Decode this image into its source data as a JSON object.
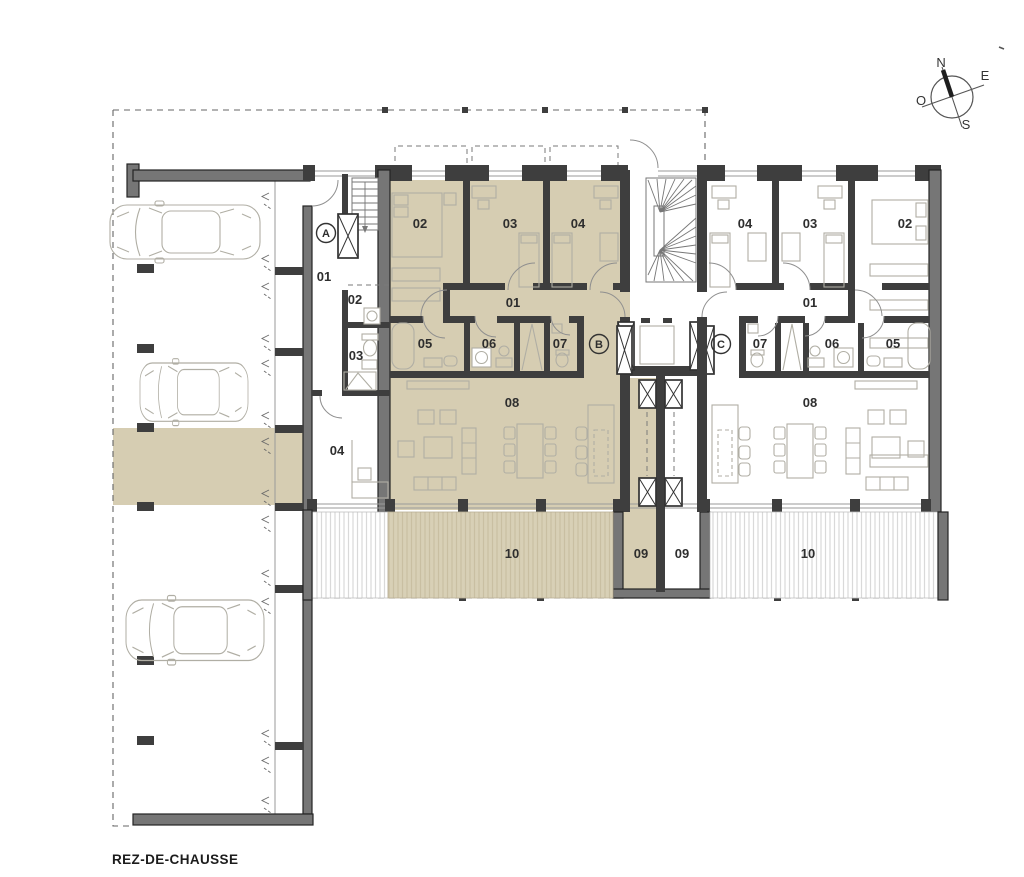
{
  "title": "REZ-DE-CHAUSSE",
  "compass": {
    "north": "N",
    "east": "E",
    "south": "S",
    "west": "O"
  },
  "axis_markers": {
    "a": "A",
    "b": "B",
    "c": "C"
  },
  "annex": {
    "corridor": "01",
    "laundry": "02",
    "wc": "03",
    "office": "04"
  },
  "apartment_left": {
    "hall": "01",
    "bedroom_1": "02",
    "bedroom_2": "03",
    "bedroom_3": "04",
    "bathroom_1": "05",
    "bathroom_2": "06",
    "bathroom_3": "07",
    "living_room": "08",
    "entry": "09",
    "terrace": "10"
  },
  "apartment_right": {
    "hall": "01",
    "bedroom_1": "02",
    "bedroom_2": "03",
    "bedroom_3": "04",
    "bathroom_1": "05",
    "bathroom_2": "06",
    "bathroom_3": "07",
    "living_room": "08",
    "entry": "09",
    "terrace": "10"
  },
  "colors": {
    "highlight": "#d6cdb2",
    "highlight_hatch_bg": "#d8d0b6",
    "highlight_hatch_line": "#c9bfa2",
    "white_hatch_line": "#d9d9d9",
    "wall_dark": "#3e3e3e",
    "wall_light": "#767676",
    "text": "#2e2e2e"
  }
}
